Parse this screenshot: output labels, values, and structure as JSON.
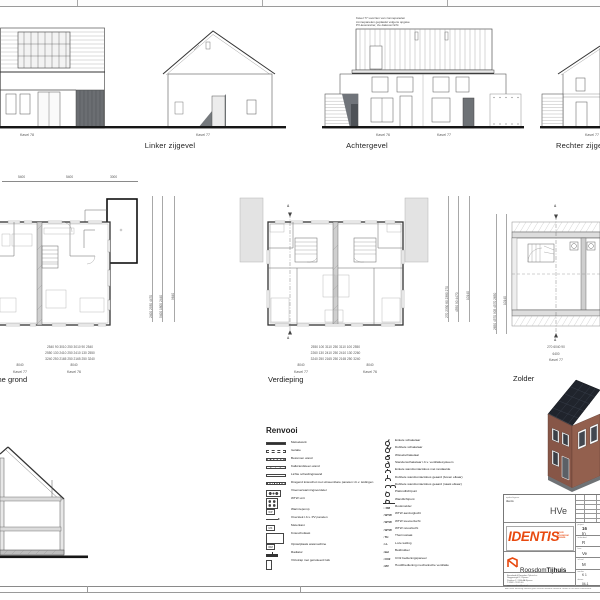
{
  "colors": {
    "accent_orange": "#E8490F",
    "line": "#4a4a4e",
    "dark_fill": "#6e7276",
    "pv_roof": "#20242c",
    "brick": "#875647"
  },
  "elevations": {
    "linker": {
      "caption": "Linker zijgevel",
      "kavel_left": "Kavel 78",
      "kavel_right": "Kavel 77"
    },
    "achter": {
      "caption": "Achtergevel",
      "kavel_left": "Kavel 76",
      "kavel_right": "Kavel 77",
      "note_lines": [
        "Kavel 77 voorzien van zonnepanelen",
        "zonnepanelen geplaatst volgens opgave",
        "PV-leverancier, zie dakoverzicht"
      ]
    },
    "rechter": {
      "caption": "Rechter zijgevel",
      "kavel": "Kavel 77"
    }
  },
  "plans": {
    "begane_grond": {
      "title": "Begane grond",
      "dims_top": [
        "5400",
        "5400",
        "3000"
      ],
      "dims_right": [
        "2400 2930 4470",
        "5400 1800 2440",
        "9640"
      ],
      "dims_bottom_rows": [
        "2540 90 3010 250 3010 90 2540",
        "2550 130 2410 250 2410 130 2550",
        "3240 250 2165 250 2165 250 3240"
      ],
      "totals": [
        "8040",
        "8040"
      ],
      "kavel_left": "Kavel 77",
      "kavel_right": "Kavel 76"
    },
    "verdieping": {
      "title": "Verdieping",
      "neighbor_left": "Kavel 78",
      "neighbor_right": "Kavel 75",
      "section_marker": "A",
      "dims_right": [
        "270 2330 80 2380 270",
        "4550 90 4470",
        "10140"
      ],
      "dims_bottom_rows": [
        "2550 100 3110 250 3110 100 2550",
        "2260 130 2410 250 2410 130 2260",
        "3240 250 2165 250 2165 250 3240"
      ],
      "totals": [
        "8040",
        "8040"
      ],
      "kavel_left": "Kavel 77",
      "kavel_right": "Kavel 76"
    },
    "zolder": {
      "title": "Zolder",
      "section_marker": "A",
      "dims_left": [
        "2650 4570 905 4570 2650",
        "10140"
      ],
      "dims_bottom_rows": [
        "270 6040 90"
      ],
      "totals": [
        "6400"
      ],
      "kavel": "Kavel 77"
    }
  },
  "legend": {
    "title": "Renvooi",
    "left_items": [
      {
        "symbol": "metselwerk-hatch",
        "label": "Metselwerk"
      },
      {
        "symbol": "isolatie-hatch",
        "label": "Isolatie"
      },
      {
        "symbol": "beton-hatch",
        "label": "Betonnen wand"
      },
      {
        "symbol": "kalkzandsteen-hatch",
        "label": "Kalkzandsteen wand"
      },
      {
        "symbol": "lichte-wand",
        "label": "Lichte scheidingswand"
      },
      {
        "symbol": "knieschot-hatch",
        "label": "Dragend knieschot met uitneembare panelen t.b.v. leidingen"
      },
      {
        "symbol": "verdeler",
        "label": "Vloerverwarmingsverdeler"
      },
      {
        "symbol": "wtw-unit",
        "label": "WTW unit"
      },
      {
        "symbol": "box",
        "code": "WP",
        "label": "Warmtepomp"
      },
      {
        "symbol": "pv-overstek",
        "label": "Overstek t.b.v. PV panelen"
      },
      {
        "symbol": "box",
        "code": "MK",
        "label": "Meterkast"
      },
      {
        "symbol": "kast",
        "label": "Knieschotkast"
      },
      {
        "symbol": "box",
        "code": "WM",
        "label": "Opstelplaats wasmachine"
      },
      {
        "symbol": "radiator",
        "label": "Radiator"
      },
      {
        "symbol": "luik",
        "label": "Vlizotrap met geïsoleerd luik"
      }
    ],
    "right_items": [
      {
        "symbol": "switch-single",
        "label": "Enkele schakelaar"
      },
      {
        "symbol": "switch-double",
        "label": "Dubbele schakelaar"
      },
      {
        "symbol": "switch-wissel",
        "label": "Wisselschakelaar"
      },
      {
        "symbol": "switch-standen",
        "label": "Standenschakelaar t.b.v. ventilatiesysteem"
      },
      {
        "symbol": "socket-single",
        "label": "Enkele wandcontactdoos met randaarde"
      },
      {
        "symbol": "socket-double-v",
        "label": "Dubbele wandcontactdoos geaard (boven elkaar)"
      },
      {
        "symbol": "socket-double-h",
        "label": "Dubbele wandcontactdoos geaard (naast elkaar)"
      },
      {
        "symbol": "light-ceiling",
        "label": "Plafondlichtpunt"
      },
      {
        "symbol": "light-wall",
        "label": "Wandlichtpunt"
      },
      {
        "symbol": "code",
        "code": "RM",
        "label": "Rookmelder"
      },
      {
        "symbol": "code",
        "code": "WTW",
        "label": "WTW aanzuiglucht"
      },
      {
        "symbol": "code",
        "code": "WTW",
        "label": "WTW toevoerlucht"
      },
      {
        "symbol": "code",
        "code": "WTW",
        "label": "WTW retourlucht"
      },
      {
        "symbol": "code",
        "code": "TH",
        "label": "Thermostaat"
      },
      {
        "symbol": "code",
        "code": "LL",
        "label": "Loze leiding"
      },
      {
        "symbol": "code",
        "code": "Bel",
        "label": "Beldrukker"
      },
      {
        "symbol": "code",
        "code": "CO2",
        "label": "CO2 bedieningspaneel"
      },
      {
        "symbol": "code",
        "code": "MV",
        "label": "Hoofdbediening mechanische ventilatie"
      }
    ]
  },
  "titleblock": {
    "client_label": "opdrachtgever",
    "client_value": "Identis",
    "code": "HVe",
    "identis_logo": "IDENTIS",
    "identis_sub": [
      "DOOR",
      "ROOSDOM",
      "TIJHUIS"
    ],
    "rt_name_regular": "Roosdom",
    "rt_name_bold": "Tijhuis",
    "address_lines": [
      "Bouwbedrijf Roosdom Tijhuis b.v.",
      "Reggesingel 2, Rijssen",
      "Postbus 2, 7460 AA Rijssen",
      "T 0548 - 53 65 00",
      "www.roosdomtijhuis.nl"
    ],
    "right_cells": {
      "project_label": "project",
      "project_lines": [
        "16",
        "In"
      ],
      "onderdeel_label": "onderdeel",
      "onderdeel_value": "R",
      "fase_label": "fase",
      "fase_value": "Ve",
      "schaal_label": "schaal",
      "schaal_value": "M",
      "werknr_label": "werknr.",
      "werknr_value": "K 1",
      "datum_label": "datum",
      "datum_value": "04-1"
    },
    "disclaimer": "Aan deze tekening kunnen geen rechten worden ontleend. Maten in het werk controleren."
  }
}
